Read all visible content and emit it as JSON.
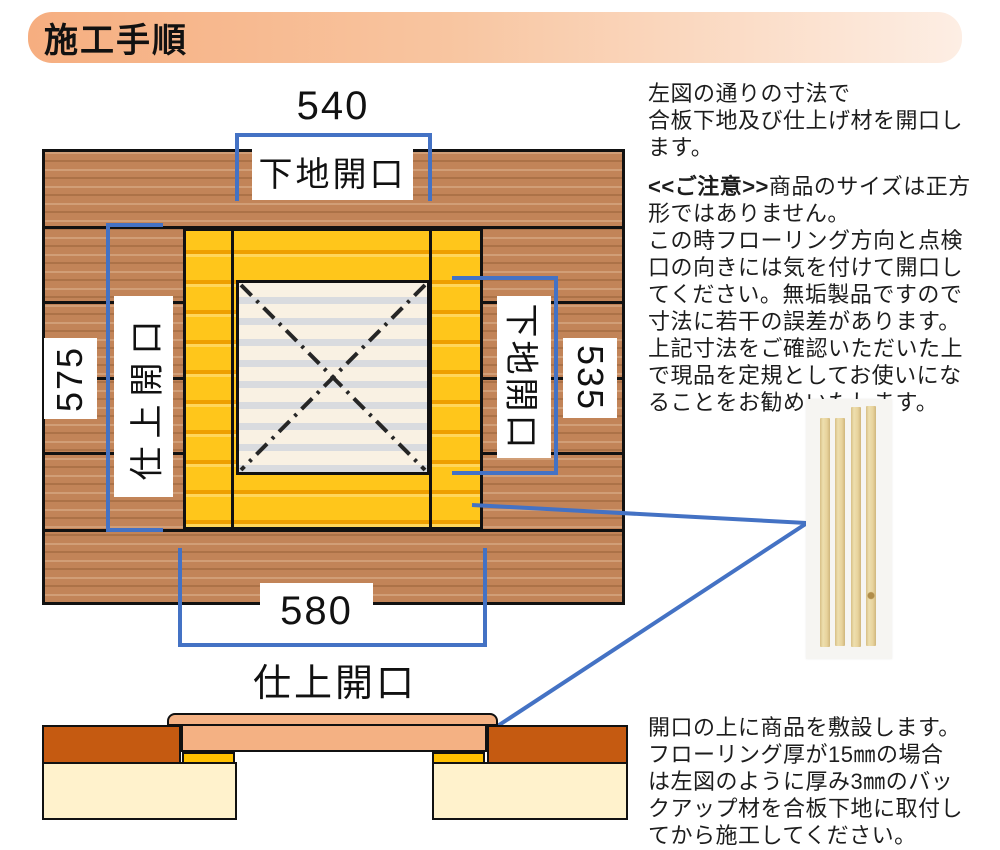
{
  "title": "施工手順",
  "colors": {
    "accent_blue": "#4472C4",
    "frame_yellow": "#FFC61B",
    "backup_yellow": "#FFC000",
    "flooring_orange": "#C55A11",
    "product_salmon": "#F4B183",
    "plywood_cream": "#FFF2CC"
  },
  "diagram": {
    "dim_top": {
      "value": "540",
      "label": "下地開口"
    },
    "dim_left": {
      "value": "575",
      "label": "仕上開口"
    },
    "dim_right": {
      "value": "535",
      "label": "下地開口"
    },
    "dim_bottom": {
      "value": "580",
      "label": "仕上開口"
    }
  },
  "right_column": {
    "para1": [
      "左図の通りの寸法で",
      "合板下地及び仕上げ材を開口し",
      "ます。"
    ],
    "notice_prefix": "<<ご注意>>",
    "para2": [
      "商品のサイズは正方",
      "形ではありません。",
      "この時フローリング方向と点検",
      "口の向きには気を付けて開口し",
      "てください。無垢製品ですので",
      "寸法に若干の誤差があります。",
      "上記寸法をご確認いただいた上",
      "で現品を定規としてお使いにな",
      "ることをお勧めいたします。"
    ],
    "para3": [
      "開口の上に商品を敷設します。",
      "フローリング厚が15㎜の場合",
      "は左図のように厚み3㎜のバッ",
      "クアップ材を合板下地に取付し",
      "てから施工してください。"
    ]
  }
}
